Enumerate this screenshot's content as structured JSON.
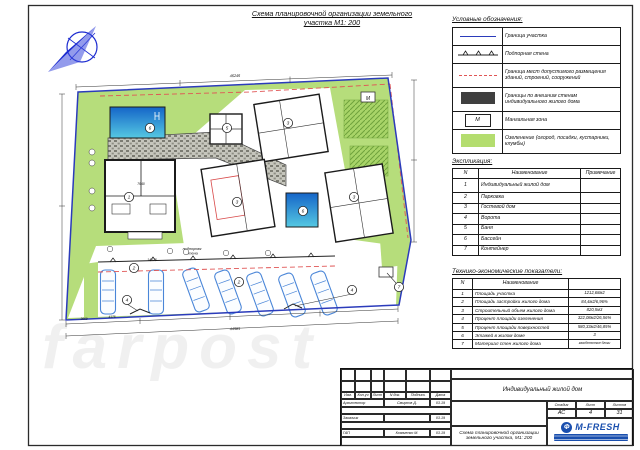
{
  "sheet": {
    "title_line1": "Схема планировочной организации земельного",
    "title_line2": "участка М1: 200"
  },
  "colors": {
    "site_green": "#b6dd7b",
    "boundary_blue": "#2b3bbb",
    "pool_blue": "#2e9fd9",
    "red_setback": "#e05555",
    "logo_blue": "#1a4fae"
  },
  "legend": {
    "title": "Условные обозначения:",
    "items": [
      {
        "symbol": "site-boundary-line",
        "label": "Граница участка"
      },
      {
        "symbol": "retaining-wall-line",
        "label": "Подпорная стена"
      },
      {
        "symbol": "red-dashed-line",
        "label": "Граница мест допустимого размещения зданий, строений, сооружений"
      },
      {
        "symbol": "dark-filled-rect",
        "label": "Границы по внешним стенам индивидуального жилого дома"
      },
      {
        "symbol": "m-box",
        "symbol_text": "М",
        "label": "Мангальная зона"
      },
      {
        "symbol": "green-rect",
        "label": "Озеленение (огород, посадки, кустарники, клумбы)"
      }
    ]
  },
  "explication": {
    "title": "Экспликация:",
    "headers": [
      "N",
      "Наименование",
      "Примечание"
    ],
    "rows": [
      {
        "n": "1",
        "name": "Индивидуальный жилой дом",
        "note": ""
      },
      {
        "n": "2",
        "name": "Парковка",
        "note": ""
      },
      {
        "n": "3",
        "name": "Гостевой дом",
        "note": ""
      },
      {
        "n": "4",
        "name": "Ворота",
        "note": ""
      },
      {
        "n": "5",
        "name": "Баня",
        "note": ""
      },
      {
        "n": "6",
        "name": "Бассейн",
        "note": ""
      },
      {
        "n": "7",
        "name": "Контейнер",
        "note": ""
      }
    ]
  },
  "tech": {
    "title": "Технико-экономические показатели:",
    "headers": [
      "N",
      "Наименование",
      ""
    ],
    "rows": [
      {
        "n": "1",
        "name": "Площадь участка",
        "value": "1212,68м2"
      },
      {
        "n": "2",
        "name": "Площадь застройки жилого дома",
        "value": "84,4м2/6,96%"
      },
      {
        "n": "3",
        "name": "Строительный объем жилого дома",
        "value": "820,5м3"
      },
      {
        "n": "4",
        "name": "Процент площади озеленения",
        "value": "322,08м2/26,56%"
      },
      {
        "n": "5",
        "name": "Процент площади поверхностей",
        "value": "580,33м2/46,85%"
      },
      {
        "n": "6",
        "name": "Этажей в жилом доме",
        "value": "3"
      },
      {
        "n": "7",
        "name": "Материал стен жилого дома",
        "value": "газобетонные блоки"
      }
    ]
  },
  "plan": {
    "callouts": [
      {
        "n": "1"
      },
      {
        "n": "5"
      },
      {
        "n": "3"
      },
      {
        "n": "3"
      },
      {
        "n": "3"
      },
      {
        "n": "6"
      },
      {
        "n": "6"
      },
      {
        "n": "2"
      },
      {
        "n": "2"
      },
      {
        "n": "4"
      },
      {
        "n": "4"
      },
      {
        "n": "7"
      }
    ],
    "m_label": "М",
    "retaining_l1": "подпорная",
    "retaining_l2": "стена",
    "dims": {
      "top": "46246",
      "bottom": "44585",
      "parking": "14025",
      "house": "7640",
      "s1": "3669",
      "s2": "4175"
    }
  },
  "title_block": {
    "project": "Индивидуальный жилой дом",
    "doc_title_line1": "Схема планировочной организации",
    "doc_title_line2": "земельного участка, М1: 200",
    "cols": [
      "Изм.",
      "Кол.уч",
      "Лист",
      "N док.",
      "Подпись",
      "Дата"
    ],
    "sign_rows": [
      {
        "role": "Архитектор",
        "name": "Смирнов Д.",
        "date": "03.19"
      },
      {
        "role": "Заказчик",
        "name": "",
        "date": "03.19"
      },
      {
        "role": "ГАП",
        "name": "Коваченко М.",
        "date": "03.19"
      }
    ],
    "stage_label": "Стадия",
    "sheet_label": "Лист",
    "sheets_label": "Листов",
    "stage": "АС",
    "sheet": "4",
    "sheets": "31",
    "logo_text": "M-FRESH"
  },
  "watermark": "farpost"
}
